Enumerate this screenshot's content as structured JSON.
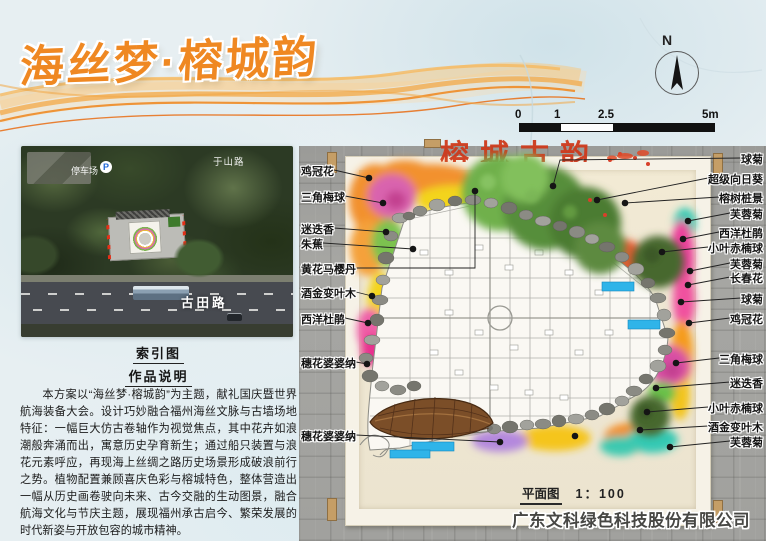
{
  "poster": {
    "title": "海丝梦·榕城韵"
  },
  "compass": {
    "label": "N"
  },
  "scalebar": {
    "ticks": [
      "0",
      "1",
      "2.5",
      "5m"
    ]
  },
  "index_map": {
    "caption": "索引图",
    "street_top": "于山路",
    "parking": "停车场",
    "parking_badge": "P",
    "road": "古田路"
  },
  "description": {
    "heading": "作品说明",
    "body": "本方案以“海丝梦·榕城韵”为主题，献礼国庆暨世界航海装备大会。设计巧妙融合福州海丝文脉与古墙场地特征：一幅巨大仿古卷轴作为视觉焦点，其中花卉如浪潮般奔涌而出，寓意历史孕育新生；通过船只装置与浪花元素呼应，再现海上丝绸之路历史场景形成破浪前行之势。植物配置兼顾喜庆色彩与榕城特色，整体营造出一幅从历史画卷驶向未来、古今交融的生动图景，融合航海文化与节庆主题，展现福州承古启今、繁荣发展的时代新姿与开放包容的城市精神。"
  },
  "plan": {
    "scroll_title": "榕城古韵",
    "caption": "平面图",
    "scale": "1：100",
    "left_labels": [
      "鸡冠花",
      "三角梅球",
      "迷迭香",
      "朱蕉",
      "黄花马樱丹",
      "酒金变叶木",
      "西洋杜鹃",
      "穗花婆婆纳",
      "穗花婆婆纳"
    ],
    "right_labels": [
      "球菊",
      "超级向日葵",
      "榕树桩景",
      "芙蓉菊",
      "西洋杜鹃",
      "小叶赤楠球",
      "芙蓉菊",
      "长春花",
      "球菊",
      "鸡冠花",
      "三角梅球",
      "迷迭香",
      "小叶赤楠球",
      "酒金变叶木",
      "芙蓉菊"
    ]
  },
  "footer": {
    "company": "广东文科绿色科技股份有限公司"
  },
  "colors": {
    "title_orange": "#EF8822",
    "scroll_red": "#CE3A1C",
    "water_blue": "#2FB4E9"
  }
}
